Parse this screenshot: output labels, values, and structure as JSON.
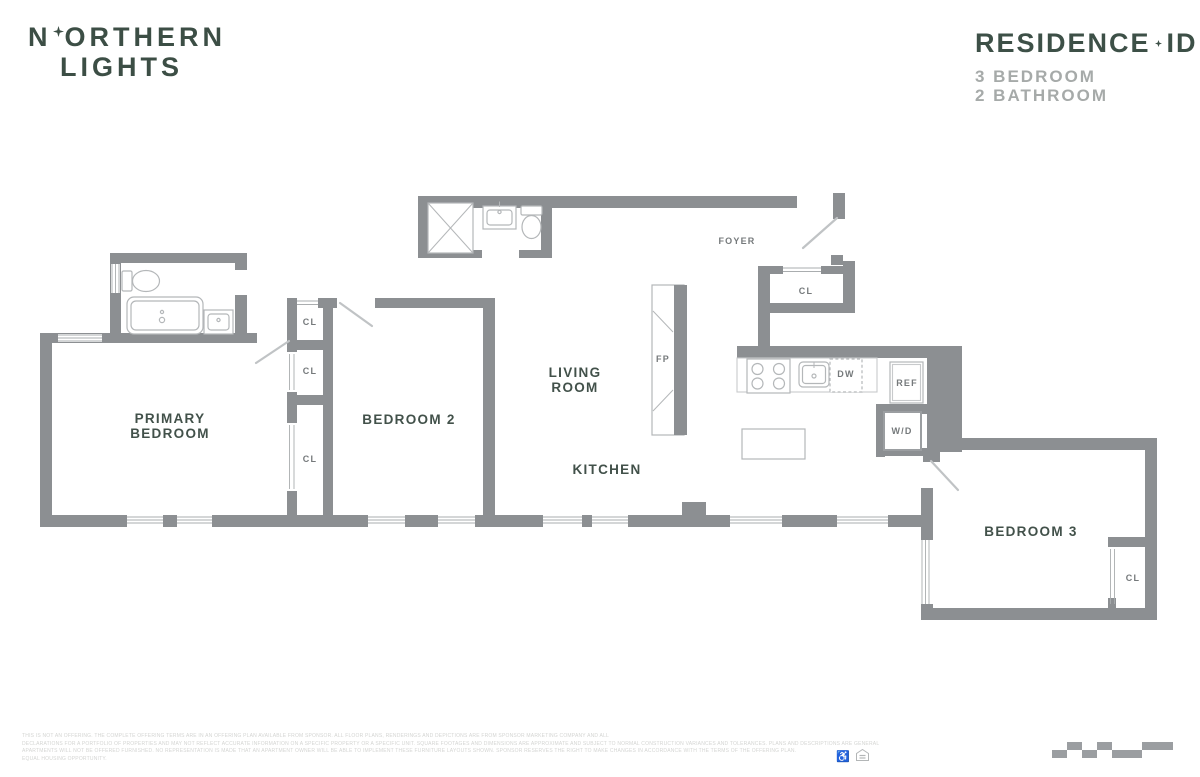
{
  "header": {
    "logo": {
      "line1_pre": "N",
      "line1_post": "ORTHERN",
      "line2": "LIGHTS"
    },
    "residence": {
      "title_main": "RESIDENCE",
      "title_id": "ID",
      "bedrooms": "3 BEDROOM",
      "bathrooms": "2 BATHROOM"
    }
  },
  "floorplan": {
    "rooms": {
      "primary_bedroom": {
        "line1": "PRIMARY",
        "line2": "BEDROOM"
      },
      "bedroom2": "BEDROOM 2",
      "living_room": {
        "line1": "LIVING",
        "line2": "ROOM"
      },
      "kitchen": "KITCHEN",
      "foyer": "FOYER",
      "bedroom3": "BEDROOM 3"
    },
    "labels": {
      "closet": "CL",
      "fireplace": "FP",
      "dishwasher": "DW",
      "refrigerator": "REF",
      "washer_dryer": "W/D"
    }
  },
  "footer": {
    "disclaimer_lines": [
      "THIS IS NOT AN OFFERING. THE COMPLETE OFFERING TERMS ARE IN AN OFFERING PLAN AVAILABLE FROM SPONSOR. ALL FLOOR PLANS, RENDERINGS AND DEPICTIONS ARE FROM SPONSOR MARKETING COMPANY AND ALL",
      "DECLARATIONS FOR A PORTFOLIO OF PROPERTIES AND MAY NOT REFLECT ACCURATE INFORMATION ON A SPECIFIC PROPERTY OR A SPECIFIC UNIT. SQUARE FOOTAGES AND DIMENSIONS ARE APPROXIMATE AND SUBJECT TO NORMAL CONSTRUCTION VARIANCES AND TOLERANCES. PLANS AND DESCRIPTIONS ARE GENERAL",
      "APARTMENTS WILL NOT BE OFFERED FURNISHED. NO REPRESENTATION IS MADE THAT AN APARTMENT OWNER WILL BE ABLE TO IMPLEMENT THESE FURNITURE LAYOUTS SHOWN. SPONSOR RESERVES THE RIGHT TO MAKE CHANGES IN ACCORDANCE WITH THE TERMS OF THE OFFERING PLAN.",
      "EQUAL HOUSING OPPORTUNITY."
    ]
  },
  "colors": {
    "wall": "#8c8f92",
    "fixture_line": "#b4b7b9",
    "label_green": "#42514a",
    "label_gray": "#75797b",
    "brand_green": "#3d5047",
    "subtitle_gray": "#a6aaa9"
  }
}
